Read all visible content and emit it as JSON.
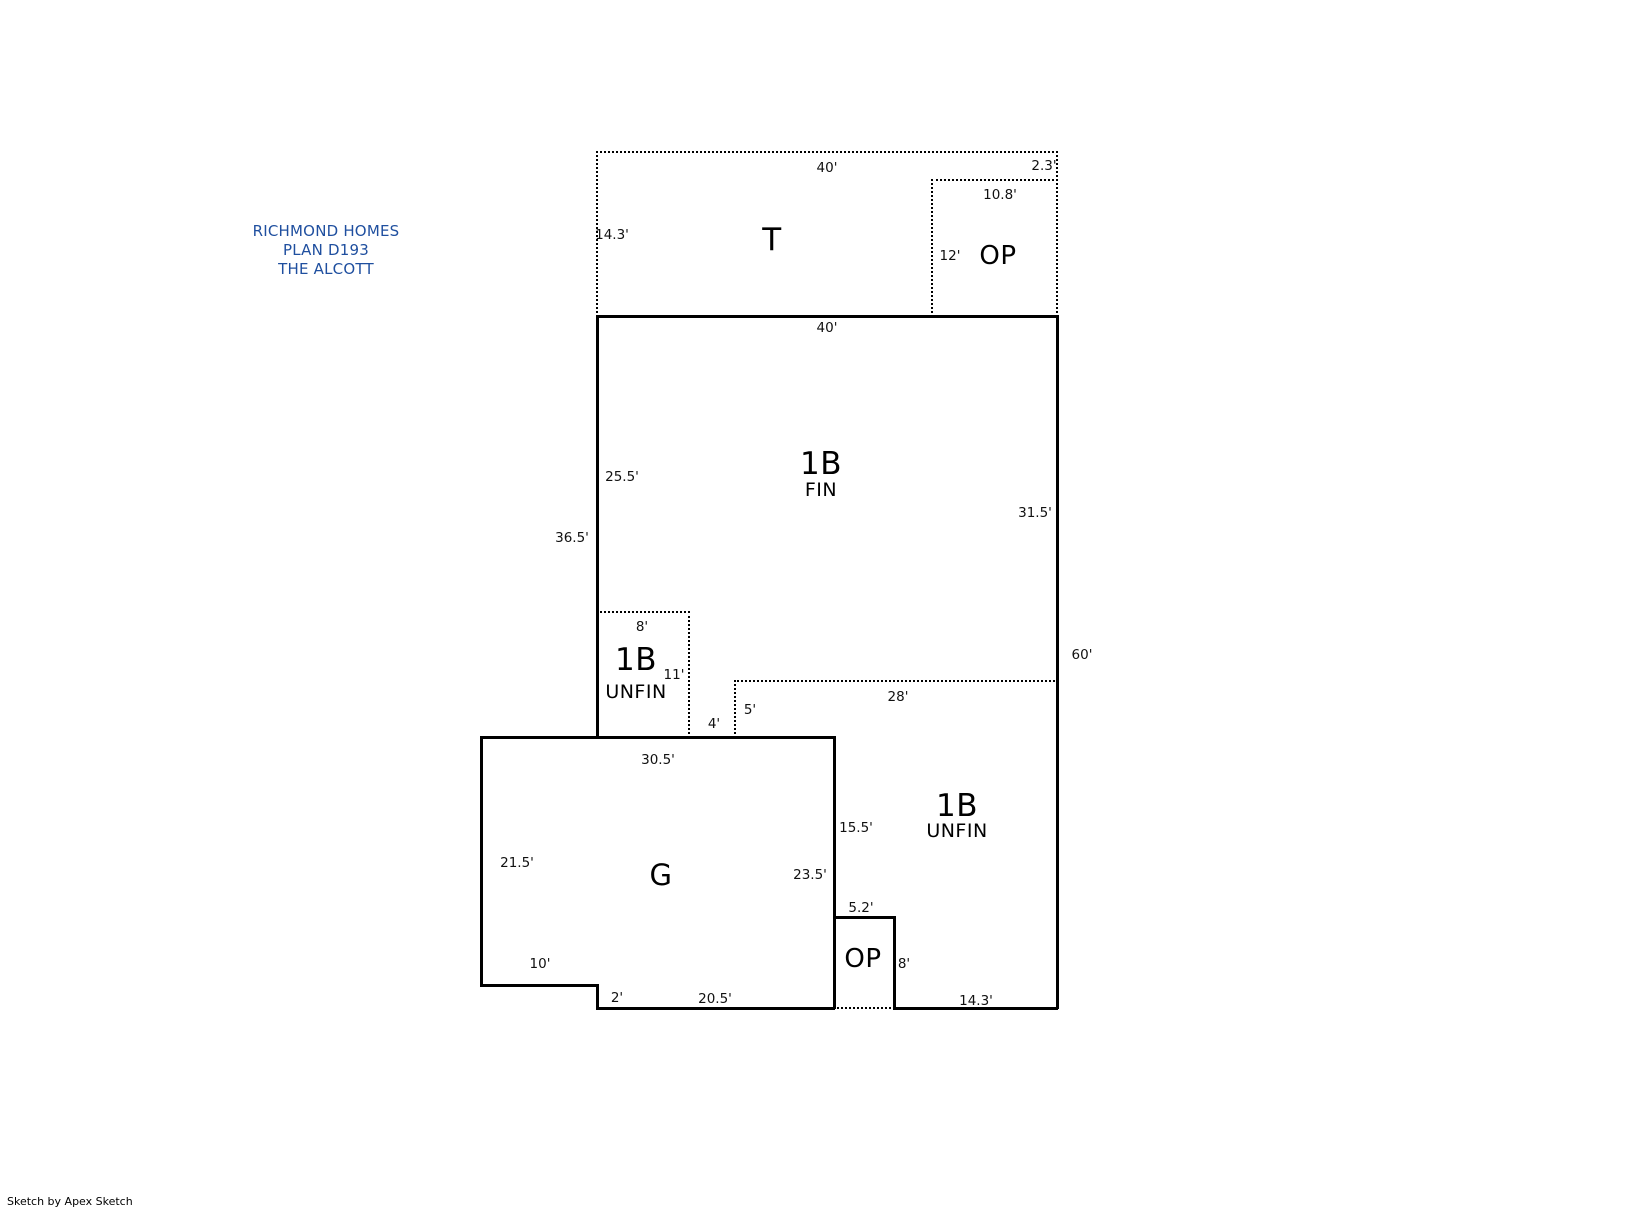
{
  "title_block": {
    "line1": "RICHMOND HOMES",
    "line2": "PLAN D193",
    "line3": "THE ALCOTT",
    "color": "#1f4f9f"
  },
  "watermark": {
    "text": "Sketch by Apex Sketch"
  },
  "plan": {
    "line_color": "#000000",
    "walls": [
      {
        "name": "terrace-top-edge",
        "style": "dotted",
        "x1": 597,
        "y1": 152,
        "x2": 1057,
        "y2": 152
      },
      {
        "name": "terrace-left-edge",
        "style": "dotted",
        "x1": 597,
        "y1": 152,
        "x2": 597,
        "y2": 316
      },
      {
        "name": "terrace-op-right-edge",
        "style": "dotted",
        "x1": 1057,
        "y1": 152,
        "x2": 1057,
        "y2": 316
      },
      {
        "name": "op-upper-top-edge",
        "style": "dotted",
        "x1": 932,
        "y1": 180,
        "x2": 1057,
        "y2": 180
      },
      {
        "name": "op-upper-left-edge",
        "style": "dotted",
        "x1": 932,
        "y1": 180,
        "x2": 932,
        "y2": 316
      },
      {
        "name": "basement-unfin-left-top-edge",
        "style": "dotted",
        "x1": 597,
        "y1": 612,
        "x2": 689,
        "y2": 612
      },
      {
        "name": "basement-unfin-left-right-edge",
        "style": "dotted",
        "x1": 689,
        "y1": 612,
        "x2": 689,
        "y2": 737
      },
      {
        "name": "basement-unfin-right-top-edge",
        "style": "dotted",
        "x1": 735,
        "y1": 681,
        "x2": 1057,
        "y2": 681
      },
      {
        "name": "basement-unfin-right-left-edge",
        "style": "dotted",
        "x1": 735,
        "y1": 681,
        "x2": 735,
        "y2": 737
      },
      {
        "name": "op-lower-bottom-edge",
        "style": "dotted",
        "x1": 834,
        "y1": 1008,
        "x2": 894,
        "y2": 1008
      },
      {
        "name": "main-top-wall",
        "style": "solid",
        "x1": 597,
        "y1": 316,
        "x2": 1057,
        "y2": 316
      },
      {
        "name": "main-left-wall",
        "style": "solid",
        "x1": 597,
        "y1": 316,
        "x2": 597,
        "y2": 737
      },
      {
        "name": "main-right-wall",
        "style": "solid",
        "x1": 1057,
        "y1": 316,
        "x2": 1057,
        "y2": 1008
      },
      {
        "name": "garage-top-wall",
        "style": "solid",
        "x1": 481,
        "y1": 737,
        "x2": 834,
        "y2": 737
      },
      {
        "name": "garage-left-wall",
        "style": "solid",
        "x1": 481,
        "y1": 737,
        "x2": 481,
        "y2": 985
      },
      {
        "name": "garage-bottom-wall-upper",
        "style": "solid",
        "x1": 481,
        "y1": 985,
        "x2": 597,
        "y2": 985
      },
      {
        "name": "garage-step-wall",
        "style": "solid",
        "x1": 597,
        "y1": 985,
        "x2": 597,
        "y2": 1008
      },
      {
        "name": "garage-bottom-wall-lower",
        "style": "solid",
        "x1": 597,
        "y1": 1008,
        "x2": 834,
        "y2": 1008
      },
      {
        "name": "garage-right-wall",
        "style": "solid",
        "x1": 834,
        "y1": 737,
        "x2": 834,
        "y2": 1008
      },
      {
        "name": "op-lower-top-wall",
        "style": "solid",
        "x1": 834,
        "y1": 917,
        "x2": 894,
        "y2": 917
      },
      {
        "name": "op-lower-right-wall",
        "style": "solid",
        "x1": 894,
        "y1": 917,
        "x2": 894,
        "y2": 1008
      },
      {
        "name": "bottom-right-wall",
        "style": "solid",
        "x1": 894,
        "y1": 1008,
        "x2": 1057,
        "y2": 1008
      }
    ],
    "dim_labels": [
      {
        "name": "dim-terrace-width",
        "text": "40'",
        "x": 827,
        "y": 168
      },
      {
        "name": "dim-op-upper-offset",
        "text": "2.3'",
        "x": 1044,
        "y": 166
      },
      {
        "name": "dim-op-upper-width",
        "text": "10.8'",
        "x": 1000,
        "y": 195
      },
      {
        "name": "dim-terrace-depth",
        "text": "14.3'",
        "x": 612,
        "y": 235
      },
      {
        "name": "dim-op-upper-depth",
        "text": "12'",
        "x": 950,
        "y": 256
      },
      {
        "name": "dim-main-width",
        "text": "40'",
        "x": 827,
        "y": 328
      },
      {
        "name": "dim-main-left-upper",
        "text": "25.5'",
        "x": 622,
        "y": 477
      },
      {
        "name": "dim-main-right-upper",
        "text": "31.5'",
        "x": 1035,
        "y": 513
      },
      {
        "name": "dim-main-left-total",
        "text": "36.5'",
        "x": 572,
        "y": 538
      },
      {
        "name": "dim-unfin-left-width",
        "text": "8'",
        "x": 642,
        "y": 627
      },
      {
        "name": "dim-unfin-left-depth",
        "text": "11'",
        "x": 674,
        "y": 675
      },
      {
        "name": "dim-right-side-total",
        "text": "60'",
        "x": 1082,
        "y": 655
      },
      {
        "name": "dim-unfin-right-width",
        "text": "28'",
        "x": 898,
        "y": 697
      },
      {
        "name": "dim-unfin-right-left",
        "text": "5'",
        "x": 750,
        "y": 710
      },
      {
        "name": "dim-garage-top-gap",
        "text": "4'",
        "x": 714,
        "y": 724
      },
      {
        "name": "dim-garage-width",
        "text": "30.5'",
        "x": 658,
        "y": 760
      },
      {
        "name": "dim-garage-right-upper",
        "text": "15.5'",
        "x": 856,
        "y": 828
      },
      {
        "name": "dim-garage-left-depth",
        "text": "21.5'",
        "x": 517,
        "y": 863
      },
      {
        "name": "dim-garage-right-depth",
        "text": "23.5'",
        "x": 810,
        "y": 875
      },
      {
        "name": "dim-op-lower-width",
        "text": "5.2'",
        "x": 861,
        "y": 908
      },
      {
        "name": "dim-op-lower-depth",
        "text": "8'",
        "x": 904,
        "y": 964
      },
      {
        "name": "dim-garage-bottom-left",
        "text": "10'",
        "x": 540,
        "y": 964
      },
      {
        "name": "dim-garage-step",
        "text": "2'",
        "x": 617,
        "y": 998
      },
      {
        "name": "dim-garage-bottom",
        "text": "20.5'",
        "x": 715,
        "y": 999
      },
      {
        "name": "dim-bottom-right",
        "text": "14.3'",
        "x": 976,
        "y": 1001
      }
    ],
    "room_labels": [
      {
        "name": "room-label-terrace",
        "text": "T",
        "x": 772,
        "y": 240,
        "size": 31
      },
      {
        "name": "room-label-op-upper",
        "text": "OP",
        "x": 998,
        "y": 256,
        "size": 26
      },
      {
        "name": "room-label-1b-fin-main",
        "text": "1B",
        "x": 821,
        "y": 464,
        "size": 31
      },
      {
        "name": "room-label-1b-fin-sub",
        "text": "FIN",
        "x": 821,
        "y": 490,
        "size": 19
      },
      {
        "name": "room-label-1b-unfin-left-main",
        "text": "1B",
        "x": 636,
        "y": 660,
        "size": 31
      },
      {
        "name": "room-label-1b-unfin-left-sub",
        "text": "UNFIN",
        "x": 636,
        "y": 692,
        "size": 19
      },
      {
        "name": "room-label-1b-unfin-right-main",
        "text": "1B",
        "x": 957,
        "y": 806,
        "size": 31
      },
      {
        "name": "room-label-1b-unfin-right-sub",
        "text": "UNFIN",
        "x": 957,
        "y": 831,
        "size": 19
      },
      {
        "name": "room-label-garage",
        "text": "G",
        "x": 661,
        "y": 875,
        "size": 29
      },
      {
        "name": "room-label-op-lower",
        "text": "OP",
        "x": 863,
        "y": 959,
        "size": 26
      }
    ]
  }
}
